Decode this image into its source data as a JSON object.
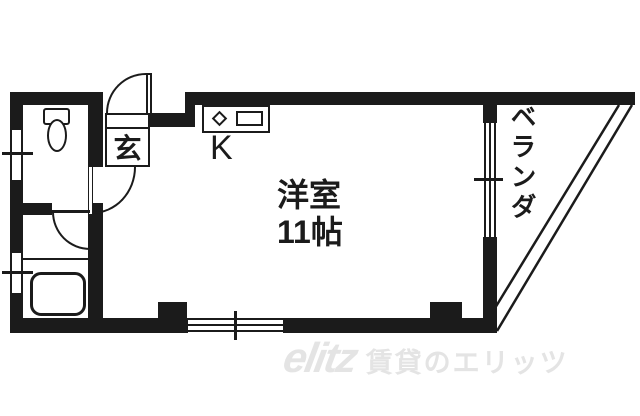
{
  "plan": {
    "rooms": {
      "genkan": {
        "label": "玄"
      },
      "kitchen": {
        "label": "K"
      },
      "western_room": {
        "name": "洋室",
        "size": "11帖"
      },
      "veranda": {
        "label": "ベランダ"
      }
    },
    "fixtures": [
      "toilet-icon",
      "bathtub-icon",
      "stove-burner-icon",
      "kitchen-sink-icon"
    ],
    "colors": {
      "wall": "#1b1b1b",
      "background": "#ffffff",
      "watermark": "#e4e4e4"
    }
  },
  "watermark": {
    "logo": "elitz",
    "text": "賃貸のエリッツ"
  }
}
